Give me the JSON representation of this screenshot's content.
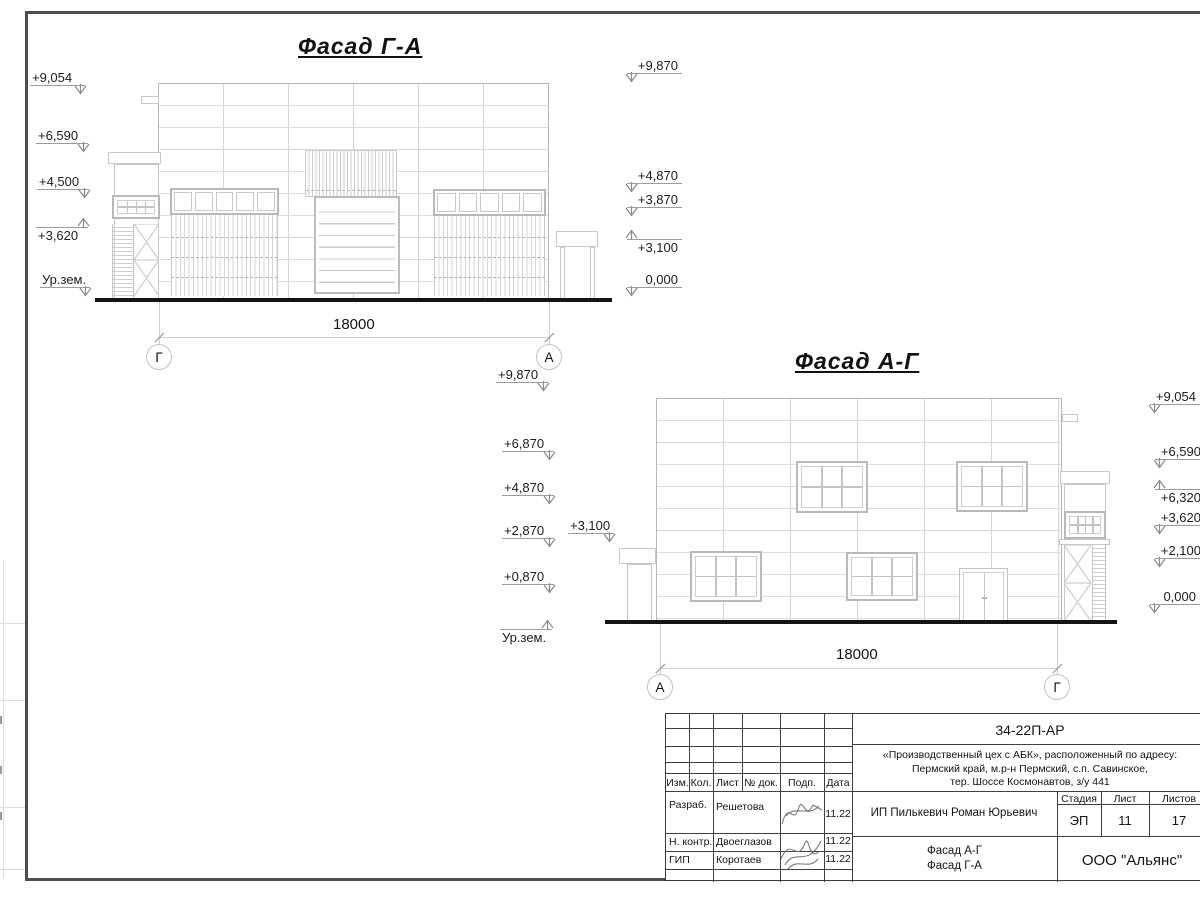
{
  "sheet": {
    "doc_number": "34-22П-АР",
    "project_address_lines": [
      "«Производственный цех с АБК», расположенный по адресу:",
      "Пермский край, м.р-н Пермский, с.п. Савинское,",
      "тер. Шоссе Космонавтов, з/у 441"
    ],
    "client": "ИП Пилькевич Роман Юрьевич",
    "stage_label": "Стадия",
    "stage_value": "ЭП",
    "sheet_label": "Лист",
    "sheet_value": "11",
    "sheets_total_label": "Листов",
    "sheets_total_value": "17",
    "content_title_lines": [
      "Фасад А-Г",
      "Фасад Г-А"
    ],
    "organization": "ООО \"Альянс\"",
    "stamp_header": [
      "Изм.",
      "Кол.",
      "Лист",
      "№ док.",
      "Подп.",
      "Дата"
    ],
    "signature_rows": [
      {
        "role": "Разраб.",
        "name": "Решетова",
        "date": "11.22"
      },
      {
        "role": "Н. контр.",
        "name": "Двоеглазов",
        "date": "11.22"
      },
      {
        "role": "ГИП",
        "name": "Коротаев",
        "date": "11.22"
      }
    ]
  },
  "facades": [
    {
      "id": "ga",
      "title": "Фасад Г-А",
      "dimension": "18000",
      "axis_left": "Г",
      "axis_right": "А",
      "marks": [
        {
          "label": "+9,054",
          "x": 30,
          "y": 70,
          "w": 55,
          "dir": "down",
          "side": "right"
        },
        {
          "label": "+6,590",
          "x": 36,
          "y": 128,
          "w": 52,
          "dir": "down",
          "side": "right"
        },
        {
          "label": "+4,500",
          "x": 37,
          "y": 174,
          "w": 52,
          "dir": "down",
          "side": "right"
        },
        {
          "label": "+3,620",
          "x": 36,
          "y": 215,
          "w": 52,
          "dir": "up",
          "side": "right"
        },
        {
          "label": "Ур.зем.",
          "x": 40,
          "y": 272,
          "w": 50,
          "dir": "down",
          "side": "right"
        },
        {
          "label": "+9,870",
          "x": 627,
          "y": 58,
          "w": 55,
          "dir": "down",
          "side": "left"
        },
        {
          "label": "+4,870",
          "x": 627,
          "y": 168,
          "w": 55,
          "dir": "down",
          "side": "left"
        },
        {
          "label": "+3,870",
          "x": 627,
          "y": 192,
          "w": 55,
          "dir": "down",
          "side": "left"
        },
        {
          "label": "+3,100",
          "x": 627,
          "y": 227,
          "w": 55,
          "dir": "up",
          "side": "left"
        },
        {
          "label": "0,000",
          "x": 627,
          "y": 272,
          "w": 55,
          "dir": "down",
          "side": "left"
        }
      ]
    },
    {
      "id": "ag",
      "title": "Фасад А-Г",
      "dimension": "18000",
      "axis_left": "А",
      "axis_right": "Г",
      "marks": [
        {
          "label": "+9,870",
          "x": 496,
          "y": 367,
          "w": 52,
          "dir": "down",
          "side": "right"
        },
        {
          "label": "+6,870",
          "x": 502,
          "y": 436,
          "w": 52,
          "dir": "down",
          "side": "right"
        },
        {
          "label": "+4,870",
          "x": 502,
          "y": 480,
          "w": 52,
          "dir": "down",
          "side": "right"
        },
        {
          "label": "+2,870",
          "x": 502,
          "y": 523,
          "w": 52,
          "dir": "down",
          "side": "right"
        },
        {
          "label": "+0,870",
          "x": 502,
          "y": 569,
          "w": 52,
          "dir": "down",
          "side": "right"
        },
        {
          "label": "Ур.зем.",
          "x": 500,
          "y": 617,
          "w": 52,
          "dir": "up",
          "side": "right"
        },
        {
          "label": "+3,100",
          "x": 568,
          "y": 518,
          "w": 46,
          "dir": "down",
          "side": "right"
        },
        {
          "label": "+9,054",
          "x": 1150,
          "y": 389,
          "w": 50,
          "dir": "down",
          "side": "left"
        },
        {
          "label": "+6,590",
          "x": 1155,
          "y": 444,
          "w": 50,
          "dir": "down",
          "side": "left"
        },
        {
          "label": "+6,320",
          "x": 1155,
          "y": 477,
          "w": 50,
          "dir": "up",
          "side": "left"
        },
        {
          "label": "+3,620",
          "x": 1155,
          "y": 510,
          "w": 50,
          "dir": "down",
          "side": "left"
        },
        {
          "label": "+2,100",
          "x": 1155,
          "y": 543,
          "w": 50,
          "dir": "down",
          "side": "left"
        },
        {
          "label": "0,000",
          "x": 1150,
          "y": 589,
          "w": 50,
          "dir": "down",
          "side": "left"
        }
      ]
    }
  ]
}
